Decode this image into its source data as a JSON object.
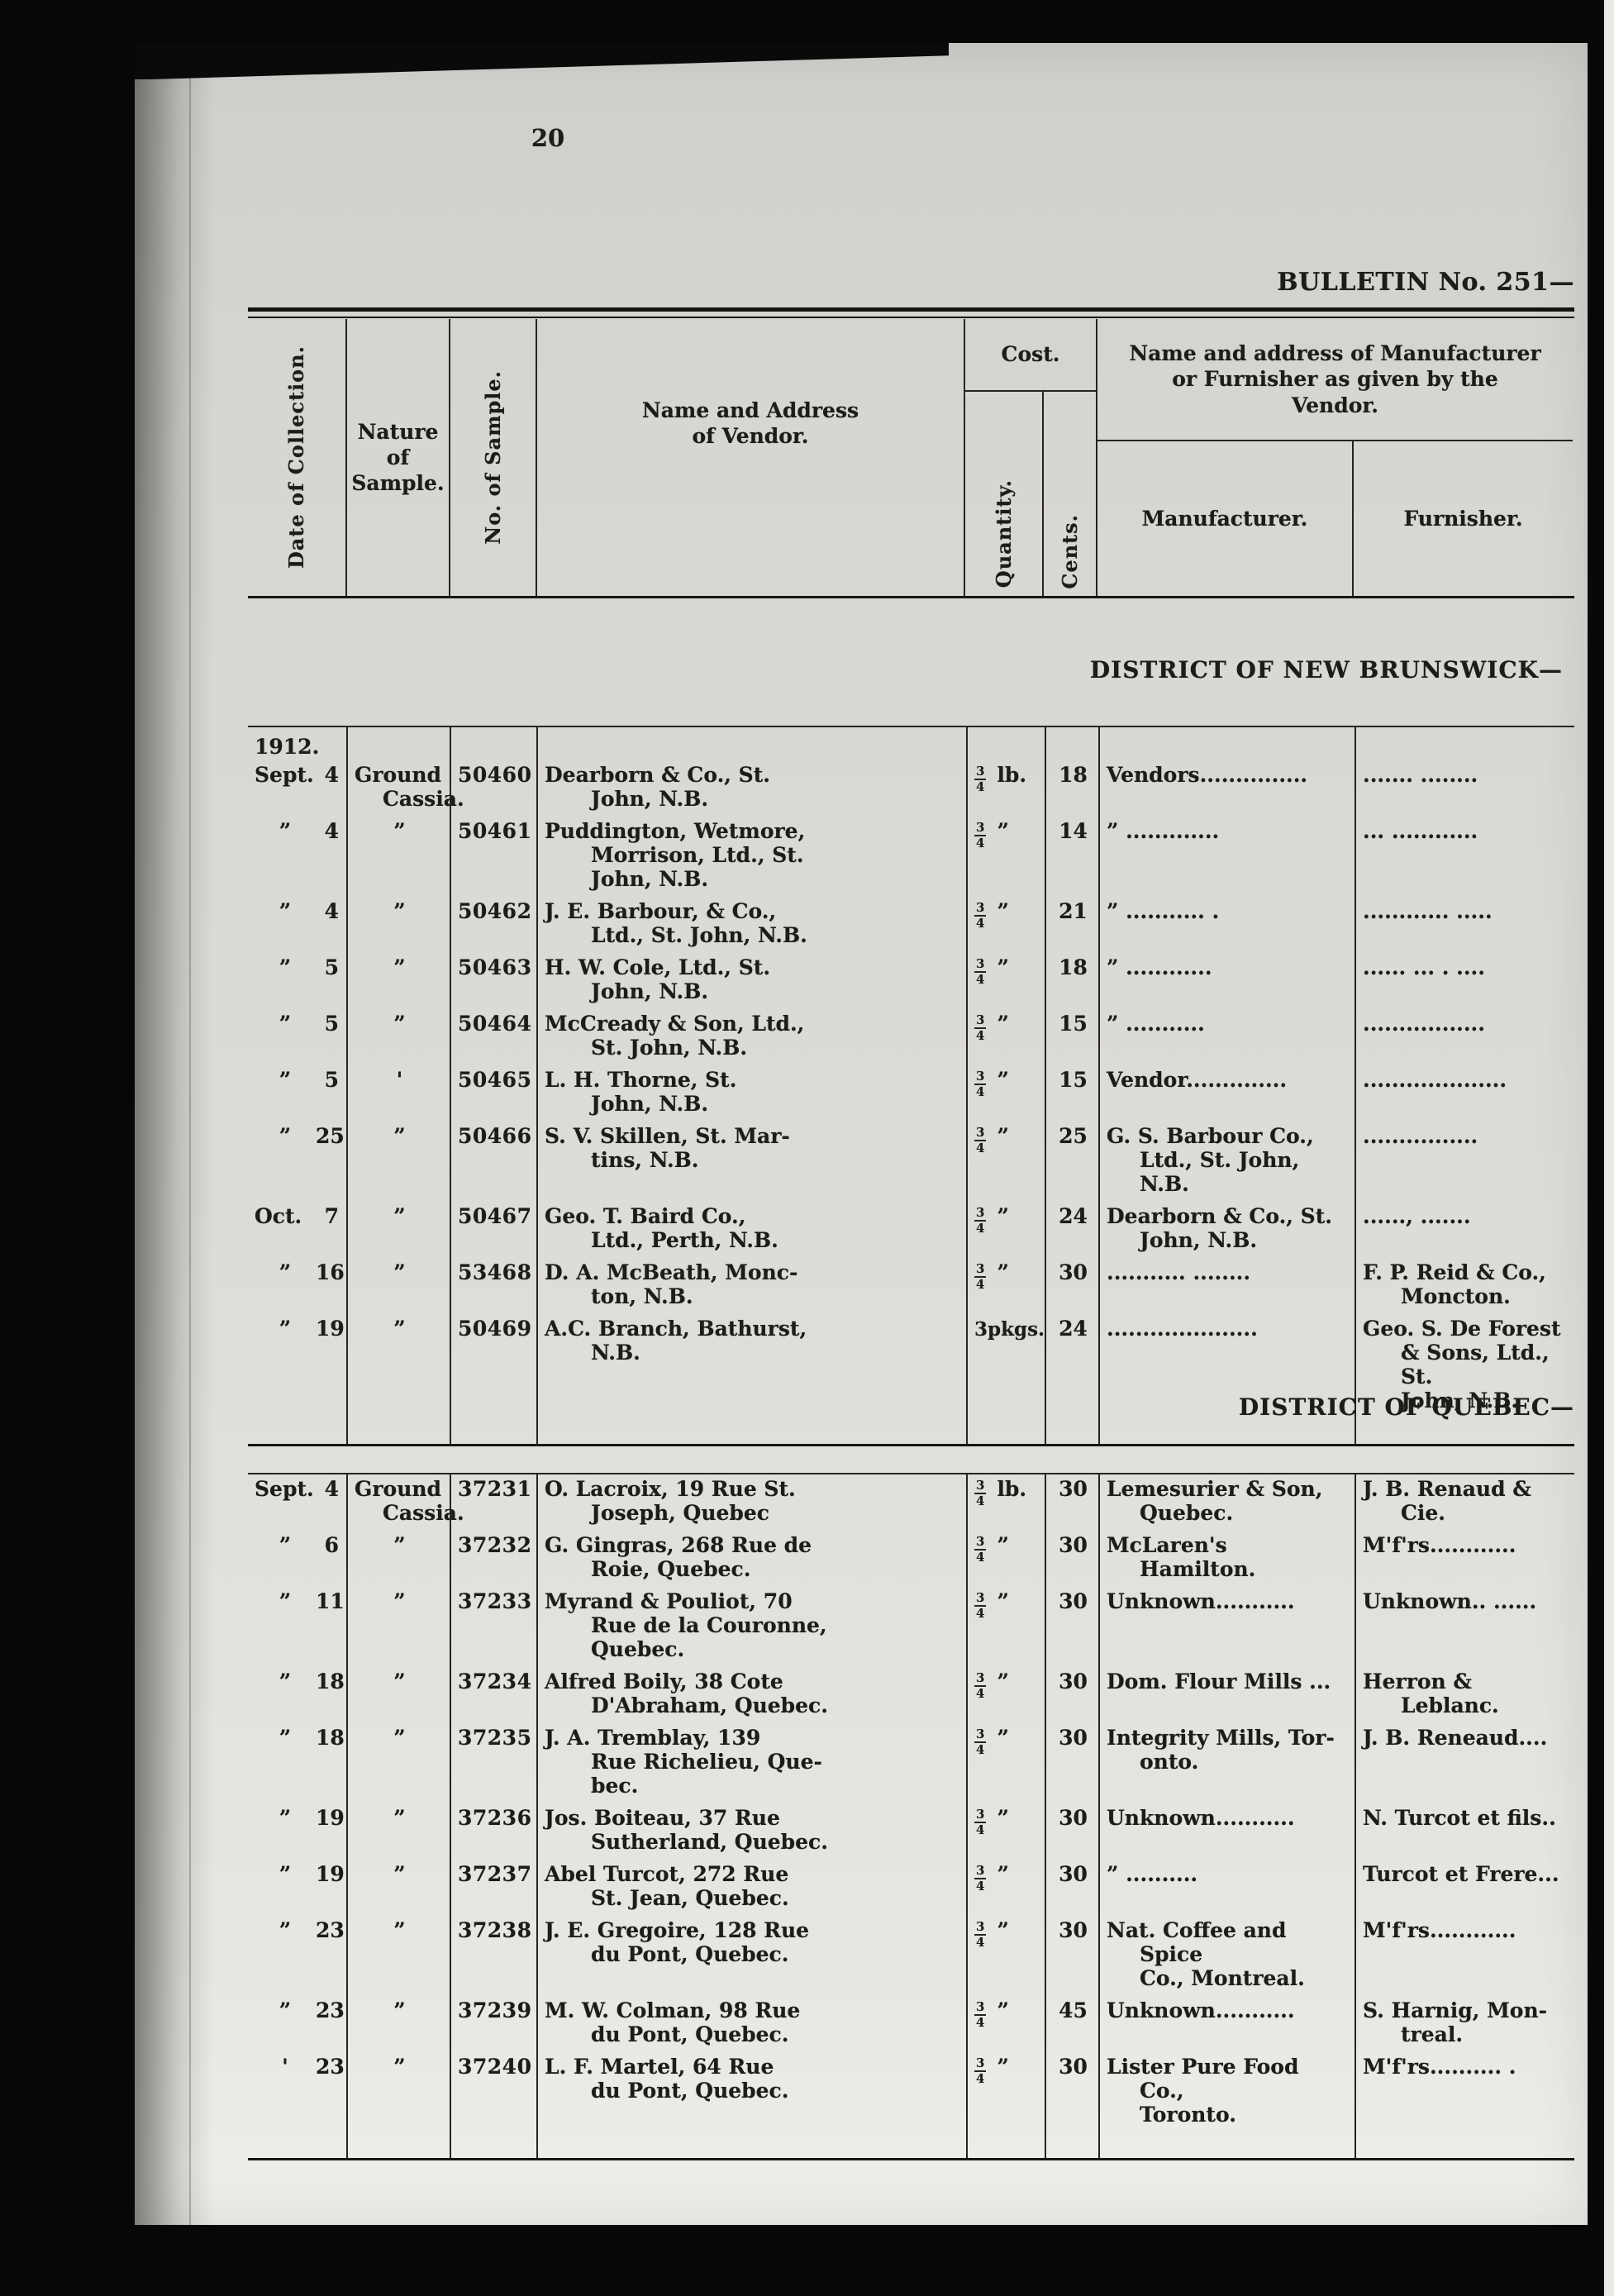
{
  "colors": {
    "background": "#070707",
    "paper": "#d7d6d2",
    "ink": "#1d1c17"
  },
  "page": {
    "number": "20",
    "bulletin_heading": "BULLETIN No. 251—"
  },
  "table_header": {
    "date": "Date of Collection.",
    "nature": "Nature\nof\nSample.",
    "no": "No. of Sample.",
    "vendor": "Name and Address\nof Vendor.",
    "cost": "Cost.",
    "quantity": "Quantity.",
    "cents": "Cents.",
    "mfr_group": "Name and address of Manufacturer\nor Furnisher as given by the\nVendor.",
    "manufacturer": "Manufacturer.",
    "furnisher": "Furnisher."
  },
  "sections": [
    {
      "heading": "DISTRICT OF NEW BRUNSWICK—",
      "year": "1912.",
      "rows": [
        {
          "month": "Sept.",
          "day": "4",
          "nature": "Ground\nCassia.",
          "no": "50460",
          "vendor": "Dearborn & Co., St.\nJohn, N.B.",
          "qty": "3/4",
          "unit": "lb.",
          "cents": "18",
          "mfr": "Vendors...............",
          "furn": ".......  ........"
        },
        {
          "month": "”",
          "day": "4",
          "nature": "”",
          "no": "50461",
          "vendor": "Puddington, Wetmore,\nMorrison, Ltd., St.\nJohn, N.B.",
          "qty": "3/4",
          "unit": "”",
          "cents": "14",
          "mfr": "”  .............",
          "furn": "...  ............"
        },
        {
          "month": "”",
          "day": "4",
          "nature": "”",
          "no": "50462",
          "vendor": "J. E. Barbour, & Co.,\nLtd., St. John, N.B.",
          "qty": "3/4",
          "unit": "”",
          "cents": "21",
          "mfr": "”  ........... .",
          "furn": "............  ....."
        },
        {
          "month": "”",
          "day": "5",
          "nature": "”",
          "no": "50463",
          "vendor": "H. W. Cole, Ltd., St.\nJohn, N.B.",
          "qty": "3/4",
          "unit": "”",
          "cents": "18",
          "mfr": "”  ............",
          "furn": "...... ... . ...."
        },
        {
          "month": "”",
          "day": "5",
          "nature": "”",
          "no": "50464",
          "vendor": "McCready & Son, Ltd.,\nSt. John, N.B.",
          "qty": "3/4",
          "unit": "”",
          "cents": "15",
          "mfr": "”  ...........",
          "furn": "................."
        },
        {
          "month": "”",
          "day": "5",
          "nature": "'",
          "no": "50465",
          "vendor": "L. H. Thorne, St.\nJohn, N.B.",
          "qty": "3/4",
          "unit": "”",
          "cents": "15",
          "mfr": "Vendor..............",
          "furn": "...................."
        },
        {
          "month": "”",
          "day": "25",
          "nature": "”",
          "no": "50466",
          "vendor": "S. V. Skillen, St. Mar-\ntins, N.B.",
          "qty": "3/4",
          "unit": "”",
          "cents": "25",
          "mfr": "G. S. Barbour Co.,\nLtd., St. John, N.B.",
          "furn": "................"
        },
        {
          "month": "Oct.",
          "day": "7",
          "nature": "”",
          "no": "50467",
          "vendor": "Geo. T. Baird Co.,\nLtd., Perth, N.B.",
          "qty": "3/4",
          "unit": "”",
          "cents": "24",
          "mfr": "Dearborn & Co., St.\nJohn, N.B.",
          "furn": "......, ......."
        },
        {
          "month": "”",
          "day": "16",
          "nature": "”",
          "no": "53468",
          "vendor": "D. A. McBeath, Monc-\nton, N.B.",
          "qty": "3/4",
          "unit": "”",
          "cents": "30",
          "mfr": "...........  ........",
          "furn": "F. P. Reid & Co.,\nMoncton."
        },
        {
          "month": "”",
          "day": "19",
          "nature": "”",
          "no": "50469",
          "vendor": "A.C. Branch, Bathurst,\nN.B.",
          "qty": "3pkgs.",
          "unit": "",
          "cents": "24",
          "mfr": ".....................",
          "furn": "Geo. S. De Forest\n& Sons, Ltd., St.\nJohn, N.B."
        }
      ]
    },
    {
      "heading": "DISTRICT OF QUEBEC—",
      "year": "",
      "rows": [
        {
          "month": "Sept.",
          "day": "4",
          "nature": "Ground\nCassia.",
          "no": "37231",
          "vendor": "O. Lacroix, 19 Rue St.\nJoseph, Quebec",
          "qty": "3/4",
          "unit": "lb.",
          "cents": "30",
          "mfr": "Lemesurier & Son,\nQuebec.",
          "furn": "J. B. Renaud &\nCie."
        },
        {
          "month": "”",
          "day": "6",
          "nature": "”",
          "no": "37232",
          "vendor": "G. Gingras, 268 Rue de\nRoie, Quebec.",
          "qty": "3/4",
          "unit": "”",
          "cents": "30",
          "mfr": "McLaren's Hamilton.",
          "furn": "M'f'rs............"
        },
        {
          "month": "”",
          "day": "11",
          "nature": "”",
          "no": "37233",
          "vendor": "Myrand & Pouliot, 70\nRue de la Couronne,\nQuebec.",
          "qty": "3/4",
          "unit": "”",
          "cents": "30",
          "mfr": "Unknown...........",
          "furn": "Unknown..  ......"
        },
        {
          "month": "”",
          "day": "18",
          "nature": "”",
          "no": "37234",
          "vendor": "Alfred Boily, 38 Cote\nD'Abraham, Quebec.",
          "qty": "3/4",
          "unit": "”",
          "cents": "30",
          "mfr": "Dom. Flour Mills ...",
          "furn": "Herron & Leblanc."
        },
        {
          "month": "”",
          "day": "18",
          "nature": "”",
          "no": "37235",
          "vendor": "J. A. Tremblay, 139\nRue Richelieu, Que-\nbec.",
          "qty": "3/4",
          "unit": "”",
          "cents": "30",
          "mfr": "Integrity Mills, Tor-\nonto.",
          "furn": "J. B. Reneaud...."
        },
        {
          "month": "”",
          "day": "19",
          "nature": "”",
          "no": "37236",
          "vendor": "Jos. Boiteau, 37 Rue\nSutherland, Quebec.",
          "qty": "3/4",
          "unit": "”",
          "cents": "30",
          "mfr": "Unknown...........",
          "furn": "N. Turcot et fils.."
        },
        {
          "month": "”",
          "day": "19",
          "nature": "”",
          "no": "37237",
          "vendor": "Abel Turcot, 272 Rue\nSt. Jean, Quebec.",
          "qty": "3/4",
          "unit": "”",
          "cents": "30",
          "mfr": "”  ..........",
          "furn": "Turcot et Frere..."
        },
        {
          "month": "”",
          "day": "23",
          "nature": "”",
          "no": "37238",
          "vendor": "J. E. Gregoire, 128 Rue\ndu Pont, Quebec.",
          "qty": "3/4",
          "unit": "”",
          "cents": "30",
          "mfr": "Nat. Coffee and Spice\nCo., Montreal.",
          "furn": "M'f'rs............"
        },
        {
          "month": "”",
          "day": "23",
          "nature": "”",
          "no": "37239",
          "vendor": "M. W. Colman, 98 Rue\ndu Pont, Quebec.",
          "qty": "3/4",
          "unit": "”",
          "cents": "45",
          "mfr": "Unknown...........",
          "furn": "S. Harnig, Mon-\ntreal."
        },
        {
          "month": "'",
          "day": "23",
          "nature": "”",
          "no": "37240",
          "vendor": "L. F. Martel, 64 Rue\ndu Pont, Quebec.",
          "qty": "3/4",
          "unit": "”",
          "cents": "30",
          "mfr": "Lister Pure Food Co.,\nToronto.",
          "furn": "M'f'rs.......... ."
        }
      ]
    }
  ]
}
